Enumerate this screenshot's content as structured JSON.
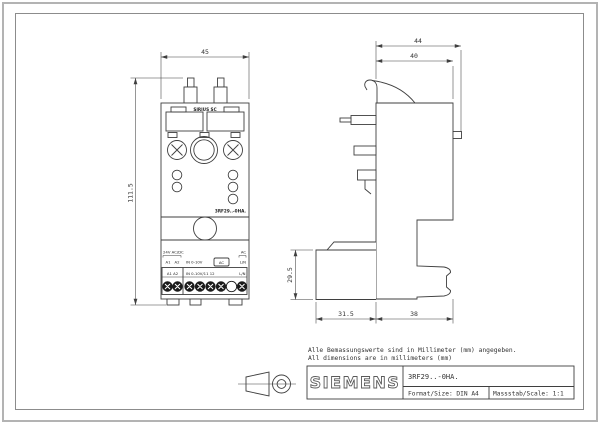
{
  "front_view": {
    "dim_width": "45",
    "dim_height": "111.5",
    "header_label": "SIRIUS SC",
    "model_label": "3RF29..-0HA.",
    "ctrl_voltage_label": "24V AC/DC",
    "ac_label": "AC",
    "pin_row": {
      "a1": "A1",
      "a2": "A2",
      "input": "IN 0-10V",
      "ac_box": "AC",
      "ln": "L/N"
    },
    "strip": {
      "left": "A1 A2",
      "mid": "IN 0-10V/11 12",
      "right": "L/N"
    }
  },
  "side_view": {
    "dim_overall_width": "44",
    "dim_body_width": "40",
    "dim_block_height": "29.5",
    "dim_block_depth": "31.5",
    "dim_base_depth": "38"
  },
  "notes": {
    "de": "Alle Bemassungswerte sind in Millimeter (mm) angegeben.",
    "en": "All dimensions are in millimeters (mm)"
  },
  "title_block": {
    "logo": "SIEMENS",
    "part_number": "3RF29..-0HA.",
    "format": "Format/Size: DIN A4",
    "scale": "Massstab/Scale: 1:1"
  },
  "colors": {
    "line": "#3f3f3f",
    "frame": "#9a9a9a"
  }
}
